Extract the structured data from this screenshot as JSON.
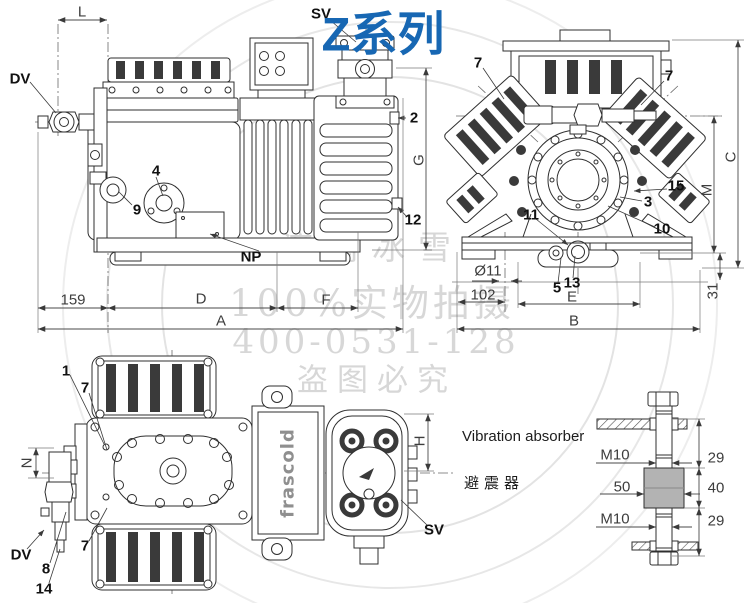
{
  "title": {
    "text": "Z系列"
  },
  "watermark": {
    "line1": "济南冰雪",
    "line2": "100%实物拍摄",
    "line3": "400-0531-128",
    "line4": "盗图必究"
  },
  "brand": {
    "logo": "frascold"
  },
  "absorber": {
    "title_en": "Vibration absorber",
    "title_zh": "避震器"
  },
  "colors": {
    "title_blue": "#1767b3",
    "watermark_gray": "#d7d7d7",
    "line_dark": "#2f2f2f",
    "dim_gray": "#3d3d3d",
    "rubber_gray": "#b3b3b3",
    "logo_gray": "#8f8f8f"
  },
  "labels": [
    {
      "name": "part-label-dv-side",
      "text": "DV",
      "x": 20,
      "y": 79,
      "cls": "part"
    },
    {
      "name": "part-label-sv-side",
      "text": "SV",
      "x": 321,
      "y": 14,
      "cls": "part"
    },
    {
      "name": "part-label-2",
      "text": "2",
      "x": 414,
      "y": 118,
      "cls": "part"
    },
    {
      "name": "part-label-4",
      "text": "4",
      "x": 156,
      "y": 171,
      "cls": "part"
    },
    {
      "name": "part-label-9",
      "text": "9",
      "x": 137,
      "y": 210,
      "cls": "part"
    },
    {
      "name": "part-label-np",
      "text": "NP",
      "x": 251,
      "y": 257,
      "cls": "part"
    },
    {
      "name": "part-label-12",
      "text": "12",
      "x": 413,
      "y": 220,
      "cls": "part"
    },
    {
      "name": "dim-label-l",
      "text": "L",
      "x": 82,
      "y": 12,
      "cls": "dim"
    },
    {
      "name": "dim-label-g",
      "text": "G",
      "x": 419,
      "y": 160,
      "cls": "dim",
      "rot": -90
    },
    {
      "name": "dim-label-159",
      "text": "159",
      "x": 73,
      "y": 300,
      "cls": "dim"
    },
    {
      "name": "dim-label-d",
      "text": "D",
      "x": 201,
      "y": 299,
      "cls": "dim"
    },
    {
      "name": "dim-label-f",
      "text": "F",
      "x": 326,
      "y": 300,
      "cls": "dim"
    },
    {
      "name": "dim-label-a",
      "text": "A",
      "x": 221,
      "y": 321,
      "cls": "dim"
    },
    {
      "name": "part-label-7-left",
      "text": "7",
      "x": 478,
      "y": 63,
      "cls": "part"
    },
    {
      "name": "part-label-7-right",
      "text": "7",
      "x": 669,
      "y": 76,
      "cls": "part"
    },
    {
      "name": "part-label-15",
      "text": "15",
      "x": 676,
      "y": 186,
      "cls": "part"
    },
    {
      "name": "part-label-3",
      "text": "3",
      "x": 648,
      "y": 202,
      "cls": "part"
    },
    {
      "name": "part-label-10",
      "text": "10",
      "x": 662,
      "y": 229,
      "cls": "part"
    },
    {
      "name": "part-label-11",
      "text": "11",
      "x": 531,
      "y": 215,
      "cls": "part"
    },
    {
      "name": "part-label-5",
      "text": "5",
      "x": 557,
      "y": 288,
      "cls": "part"
    },
    {
      "name": "part-label-13",
      "text": "13",
      "x": 572,
      "y": 283,
      "cls": "part"
    },
    {
      "name": "dim-label-c",
      "text": "C",
      "x": 731,
      "y": 157,
      "cls": "dim",
      "rot": -90
    },
    {
      "name": "dim-label-m",
      "text": "M",
      "x": 707,
      "y": 190,
      "cls": "dim",
      "rot": -90
    },
    {
      "name": "dim-label-31",
      "text": "31",
      "x": 713,
      "y": 291,
      "cls": "dim",
      "rot": -90
    },
    {
      "name": "dim-label-b",
      "text": "B",
      "x": 574,
      "y": 321,
      "cls": "dim"
    },
    {
      "name": "dim-label-e",
      "text": "E",
      "x": 572,
      "y": 297,
      "cls": "dim"
    },
    {
      "name": "dim-label-102",
      "text": "102",
      "x": 483,
      "y": 295,
      "cls": "dim"
    },
    {
      "name": "dim-label-dia11",
      "text": "Ø11",
      "x": 488,
      "y": 271,
      "cls": "dim"
    },
    {
      "name": "part-label-1",
      "text": "1",
      "x": 66,
      "y": 371,
      "cls": "part"
    },
    {
      "name": "part-label-7-top",
      "text": "7",
      "x": 85,
      "y": 388,
      "cls": "part"
    },
    {
      "name": "part-label-7-bottom",
      "text": "7",
      "x": 85,
      "y": 546,
      "cls": "part"
    },
    {
      "name": "part-label-dv-topview",
      "text": "DV",
      "x": 21,
      "y": 555,
      "cls": "part"
    },
    {
      "name": "part-label-8",
      "text": "8",
      "x": 46,
      "y": 569,
      "cls": "part"
    },
    {
      "name": "part-label-14",
      "text": "14",
      "x": 44,
      "y": 589,
      "cls": "part"
    },
    {
      "name": "part-label-sv-topview",
      "text": "SV",
      "x": 434,
      "y": 530,
      "cls": "part"
    },
    {
      "name": "dim-label-n",
      "text": "N",
      "x": 27,
      "y": 463,
      "cls": "dim",
      "rot": -90
    },
    {
      "name": "dim-label-h",
      "text": "H",
      "x": 420,
      "y": 441,
      "cls": "dim",
      "rot": -90
    },
    {
      "name": "dim-label-m10-top",
      "text": "M10",
      "x": 615,
      "y": 455,
      "cls": "dim"
    },
    {
      "name": "dim-label-29-top",
      "text": "29",
      "x": 716,
      "y": 458,
      "cls": "dim"
    },
    {
      "name": "dim-label-50",
      "text": "50",
      "x": 622,
      "y": 487,
      "cls": "dim"
    },
    {
      "name": "dim-label-40",
      "text": "40",
      "x": 716,
      "y": 488,
      "cls": "dim"
    },
    {
      "name": "dim-label-m10-bottom",
      "text": "M10",
      "x": 615,
      "y": 519,
      "cls": "dim"
    },
    {
      "name": "dim-label-29-bottom",
      "text": "29",
      "x": 716,
      "y": 521,
      "cls": "dim"
    }
  ]
}
